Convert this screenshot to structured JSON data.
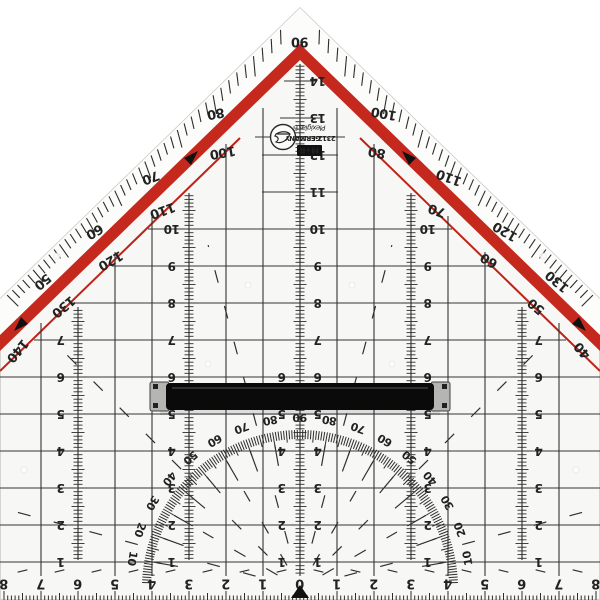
{
  "brand": {
    "box_label": "M+R",
    "country": "GERMANY",
    "model": "2312",
    "material": "Plexiglas®"
  },
  "edge_scale": {
    "apex_label": "90",
    "left_pairs": [
      {
        "outer": "80",
        "inner": "100"
      },
      {
        "outer": "70",
        "inner": "110"
      },
      {
        "outer": "60",
        "inner": "120"
      },
      {
        "outer": "50",
        "inner": "130"
      }
    ],
    "left_end_inner": "140",
    "right_pairs": [
      {
        "outer": "100",
        "inner": "80"
      },
      {
        "outer": "110",
        "inner": "70"
      },
      {
        "outer": "120",
        "inner": "60"
      },
      {
        "outer": "130",
        "inner": "50"
      }
    ],
    "right_end_inner": "40"
  },
  "protractor": {
    "labels": [
      "10",
      "20",
      "30",
      "40",
      "50",
      "60",
      "70",
      "80",
      "90",
      "80",
      "70",
      "60",
      "50",
      "40",
      "30",
      "20",
      "10"
    ]
  },
  "rulers": {
    "center_values": [
      "1",
      "2",
      "3",
      "4",
      "5",
      "6",
      "7",
      "8",
      "9",
      "10",
      "11",
      "12",
      "13",
      "14"
    ],
    "side_long_values": [
      "1",
      "2",
      "3",
      "4",
      "5",
      "6",
      "7",
      "8",
      "9",
      "10"
    ],
    "side_short_values": [
      "1",
      "2",
      "3",
      "4",
      "5",
      "6",
      "7"
    ],
    "bottom_values": [
      "0",
      "1",
      "2",
      "3",
      "4",
      "5",
      "6",
      "7",
      "8"
    ]
  },
  "colors": {
    "band_red": "#c5281c",
    "pinstripe_red": "#bf2317",
    "ink": "#262626",
    "body": "#f7f7f5",
    "bevel": "#fcfcfb",
    "handle_black": "#0a0a0a",
    "cap_gray": "#b5b5b2"
  }
}
